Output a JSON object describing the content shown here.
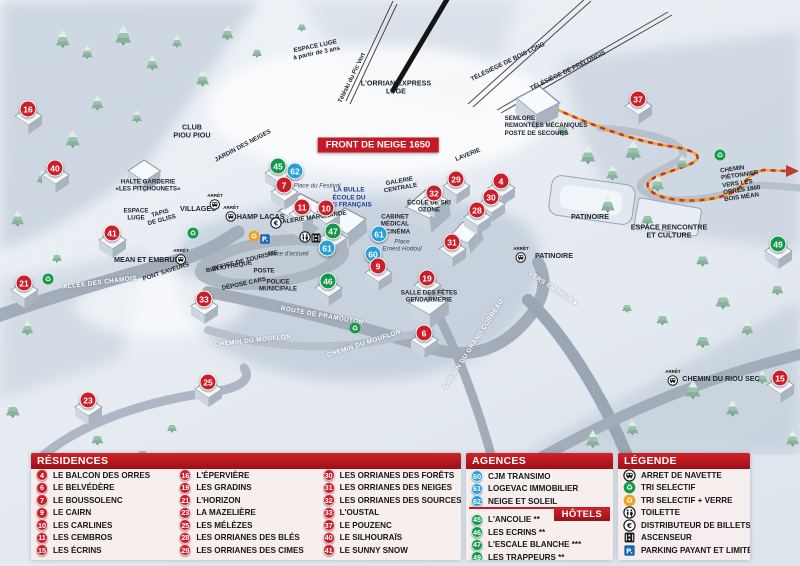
{
  "map": {
    "banner": "FRONT DE NEIGE 1650",
    "markers": [
      {
        "n": "16",
        "t": "r",
        "x": 28,
        "y": 109
      },
      {
        "n": "40",
        "t": "r",
        "x": 55,
        "y": 168
      },
      {
        "n": "21",
        "t": "r",
        "x": 24,
        "y": 283
      },
      {
        "n": "41",
        "t": "r",
        "x": 112,
        "y": 233
      },
      {
        "n": "33",
        "t": "r",
        "x": 204,
        "y": 299
      },
      {
        "n": "23",
        "t": "r",
        "x": 88,
        "y": 400
      },
      {
        "n": "25",
        "t": "r",
        "x": 208,
        "y": 382
      },
      {
        "n": "45",
        "t": "g",
        "x": 278,
        "y": 166
      },
      {
        "n": "62",
        "t": "b",
        "x": 295,
        "y": 171
      },
      {
        "n": "7",
        "t": "r",
        "x": 284,
        "y": 185
      },
      {
        "n": "11",
        "t": "r",
        "x": 302,
        "y": 207
      },
      {
        "n": "10",
        "t": "r",
        "x": 326,
        "y": 208
      },
      {
        "n": "47",
        "t": "g",
        "x": 333,
        "y": 231
      },
      {
        "n": "61",
        "t": "b",
        "x": 327,
        "y": 248
      },
      {
        "n": "61",
        "t": "b",
        "x": 379,
        "y": 234
      },
      {
        "n": "60",
        "t": "b",
        "x": 373,
        "y": 254
      },
      {
        "n": "9",
        "t": "r",
        "x": 378,
        "y": 266
      },
      {
        "n": "46",
        "t": "g",
        "x": 328,
        "y": 281
      },
      {
        "n": "19",
        "t": "r",
        "x": 427,
        "y": 278
      },
      {
        "n": "31",
        "t": "r",
        "x": 452,
        "y": 242
      },
      {
        "n": "6",
        "t": "r",
        "x": 424,
        "y": 333
      },
      {
        "n": "29",
        "t": "r",
        "x": 456,
        "y": 179
      },
      {
        "n": "32",
        "t": "r",
        "x": 434,
        "y": 193
      },
      {
        "n": "4",
        "t": "r",
        "x": 501,
        "y": 181
      },
      {
        "n": "30",
        "t": "r",
        "x": 491,
        "y": 197
      },
      {
        "n": "28",
        "t": "r",
        "x": 477,
        "y": 210
      },
      {
        "n": "37",
        "t": "r",
        "x": 638,
        "y": 99
      },
      {
        "n": "49",
        "t": "g",
        "x": 778,
        "y": 244
      },
      {
        "n": "15",
        "t": "r",
        "x": 780,
        "y": 378
      }
    ],
    "labels": [
      {
        "t": "ESPACE LUGE\nà partir de 3 ans",
        "x": 316,
        "y": 50,
        "r": -12,
        "c": "tiny"
      },
      {
        "t": "Téléski du Pic Vert",
        "x": 352,
        "y": 78,
        "r": -64,
        "c": "tiny"
      },
      {
        "t": "L'ORRIAN EXPRESS\nLUGE",
        "x": 396,
        "y": 88,
        "r": 0,
        "c": "dark"
      },
      {
        "t": "TÉLÉSIÈGE DE BOIS LONG",
        "x": 508,
        "y": 62,
        "r": -26,
        "c": "tiny"
      },
      {
        "t": "TÉLÉSIÈGE DE PRÉLONGIS",
        "x": 568,
        "y": 71,
        "r": -26,
        "c": "tiny"
      },
      {
        "t": "CLUB\nPIOU PIOU",
        "x": 192,
        "y": 132,
        "r": 0,
        "c": "dark"
      },
      {
        "t": "JARDIN DES NEIGES",
        "x": 243,
        "y": 146,
        "r": -28,
        "c": "tiny"
      },
      {
        "t": "HALTE GARDERIE\n«LES PITCHOUNETS»",
        "x": 148,
        "y": 186,
        "r": 0,
        "c": "tiny"
      },
      {
        "t": "ESPACE\nLUGE",
        "x": 136,
        "y": 215,
        "r": 0,
        "c": "tiny"
      },
      {
        "t": "TAPIS\nDE GLISS",
        "x": 161,
        "y": 217,
        "r": -15,
        "c": "tiny"
      },
      {
        "t": "VILLAGES",
        "x": 198,
        "y": 209,
        "r": 0,
        "c": "dark"
      },
      {
        "t": "CHAMP LACAS",
        "x": 258,
        "y": 217,
        "r": 0,
        "c": "dark"
      },
      {
        "t": "SEMLORE\nREMONTÉES MÉCANIQUES\nPOSTE DE SECOURS",
        "x": 546,
        "y": 126,
        "r": 0,
        "c": "tiny left"
      },
      {
        "t": "LAVERIE",
        "x": 468,
        "y": 155,
        "r": -22,
        "c": "tiny"
      },
      {
        "t": "GALERIE\nCENTRALE",
        "x": 400,
        "y": 185,
        "r": -10,
        "c": "tiny"
      },
      {
        "t": "Place du Festival",
        "x": 317,
        "y": 186,
        "r": 0,
        "c": "ital"
      },
      {
        "t": "LA BULLE\nÉCOLE DU\nSKI FRANÇAIS",
        "x": 349,
        "y": 198,
        "r": 0,
        "c": "blue"
      },
      {
        "t": "GALERIE MARCHANDE",
        "x": 312,
        "y": 218,
        "r": -8,
        "c": "tiny"
      },
      {
        "t": "ÉCOLE DE SKI\nOZONE",
        "x": 429,
        "y": 207,
        "r": 0,
        "c": "tiny"
      },
      {
        "t": "CABINET\nMÉDICAL",
        "x": 395,
        "y": 221,
        "r": 0,
        "c": "tiny"
      },
      {
        "t": "CINÉMA",
        "x": 398,
        "y": 232,
        "r": 0,
        "c": "tiny"
      },
      {
        "t": "Place\nErnest Hodoul",
        "x": 402,
        "y": 246,
        "r": 0,
        "c": "ital"
      },
      {
        "t": "Place d'accueil",
        "x": 288,
        "y": 254,
        "r": 0,
        "c": "ital"
      },
      {
        "t": "OFFICE DE TOURISME",
        "x": 245,
        "y": 261,
        "r": -14,
        "c": "tiny"
      },
      {
        "t": "BIBLIOTHÈQUE",
        "x": 229,
        "y": 267,
        "r": -10,
        "c": "tiny"
      },
      {
        "t": "POSTE",
        "x": 264,
        "y": 271,
        "r": 0,
        "c": "tiny"
      },
      {
        "t": "DÉPOSE CARS",
        "x": 244,
        "y": 284,
        "r": -12,
        "c": "tiny"
      },
      {
        "t": "POLICE\nMUNICIPALE",
        "x": 278,
        "y": 286,
        "r": 0,
        "c": "tiny"
      },
      {
        "t": "PONT SAVEURS",
        "x": 166,
        "y": 272,
        "r": -18,
        "c": "tiny"
      },
      {
        "t": "MEAN ET EMBRUN",
        "x": 147,
        "y": 260,
        "r": 0,
        "c": "dark"
      },
      {
        "t": "ALLÉE DES CHAMOIS",
        "x": 100,
        "y": 283,
        "r": -7,
        "c": "road"
      },
      {
        "t": "ROUTE DE PRAMOUTON",
        "x": 322,
        "y": 316,
        "r": 10,
        "c": "road"
      },
      {
        "t": "CHEMIN DU MOUFLON",
        "x": 253,
        "y": 341,
        "r": -6,
        "c": "road"
      },
      {
        "t": "CHEMIN DU MOUFLON",
        "x": 364,
        "y": 344,
        "r": -18,
        "c": "road"
      },
      {
        "t": "CHEMIN DU GRAND CORBEAU",
        "x": 474,
        "y": 344,
        "r": -57,
        "c": "road"
      },
      {
        "t": "VERS EMBRUN ▸",
        "x": 553,
        "y": 289,
        "r": 33,
        "c": "road"
      },
      {
        "t": "SALLE DES FÊTES\nGENDARMERIE",
        "x": 429,
        "y": 297,
        "r": 0,
        "c": "tiny"
      },
      {
        "t": "PATINOIRE",
        "x": 590,
        "y": 217,
        "r": 0,
        "c": "dark"
      },
      {
        "t": "PATINOIRE",
        "x": 554,
        "y": 256,
        "r": 0,
        "c": "dark"
      },
      {
        "t": "ESPACE RENCONTRE\nET CULTURE",
        "x": 669,
        "y": 232,
        "r": 0,
        "c": "dark"
      },
      {
        "t": "CHEMIN PIÉTONNIER\nVERS LES ORRES 1800\nBOIS MÉAN",
        "x": 748,
        "y": 182,
        "r": -8,
        "c": "tiny left"
      },
      {
        "t": "CHEMIN DU RIOU SEC",
        "x": 721,
        "y": 379,
        "r": 0,
        "c": "dark"
      }
    ],
    "icons": [
      {
        "t": "bus",
        "x": 215,
        "y": 202
      },
      {
        "t": "bus",
        "x": 231,
        "y": 214
      },
      {
        "t": "bus",
        "x": 181,
        "y": 257
      },
      {
        "t": "bus",
        "x": 521,
        "y": 255
      },
      {
        "t": "bus",
        "x": 673,
        "y": 378
      },
      {
        "t": "recycle-green",
        "x": 193,
        "y": 233
      },
      {
        "t": "recycle-green",
        "x": 48,
        "y": 279
      },
      {
        "t": "recycle-green",
        "x": 355,
        "y": 328
      },
      {
        "t": "recycle-green",
        "x": 720,
        "y": 155
      },
      {
        "t": "recycle-yellow",
        "x": 254,
        "y": 236
      },
      {
        "t": "parking",
        "x": 265,
        "y": 239
      },
      {
        "t": "euro",
        "x": 276,
        "y": 223
      },
      {
        "t": "wc",
        "x": 305,
        "y": 237
      },
      {
        "t": "elevator",
        "x": 316,
        "y": 238
      }
    ]
  },
  "legend": {
    "residences": {
      "title": "RÉSIDENCES",
      "items": [
        {
          "n": "4",
          "label": "LE BALCON DES ORRES"
        },
        {
          "n": "6",
          "label": "LE BELVÉDÈRE"
        },
        {
          "n": "7",
          "label": "LE BOUSSOLENC"
        },
        {
          "n": "9",
          "label": "LE CAIRN"
        },
        {
          "n": "10",
          "label": "LES CARLINES"
        },
        {
          "n": "11",
          "label": "LES CEMBROS"
        },
        {
          "n": "15",
          "label": "LES ÉCRINS"
        },
        {
          "n": "16",
          "label": "L'ÉPERVIÈRE"
        },
        {
          "n": "19",
          "label": "LES GRADINS"
        },
        {
          "n": "21",
          "label": "L'HORIZON"
        },
        {
          "n": "23",
          "label": "LA MAZELIÈRE"
        },
        {
          "n": "25",
          "label": "LES MÉLÈZES"
        },
        {
          "n": "28",
          "label": "LES ORRIANES DES BLÉS"
        },
        {
          "n": "29",
          "label": "LES ORRIANES DES CIMES"
        },
        {
          "n": "30",
          "label": "LES ORRIANES DES FORÊTS"
        },
        {
          "n": "31",
          "label": "LES ORRIANES DES NEIGES"
        },
        {
          "n": "32",
          "label": "LES ORRIANES DES SOURCES"
        },
        {
          "n": "33",
          "label": "L'OUSTAL"
        },
        {
          "n": "37",
          "label": "LE POUZENC"
        },
        {
          "n": "40",
          "label": "LE SILHOURAÏS"
        },
        {
          "n": "41",
          "label": "LE SUNNY SNOW"
        }
      ]
    },
    "agencies": {
      "title": "AGENCES IMMOBILIÈRES",
      "items": [
        {
          "n": "60",
          "label": "CJM TRANSIMO"
        },
        {
          "n": "61",
          "label": "LOGEVAC IMMOBILIER"
        },
        {
          "n": "62",
          "label": "NEIGE ET SOLEIL"
        }
      ]
    },
    "hotels": {
      "title": "HÔTELS",
      "items": [
        {
          "n": "45",
          "label": "L'ANCOLIE **"
        },
        {
          "n": "46",
          "label": "LES ECRINS **"
        },
        {
          "n": "47",
          "label": "L'ESCALE BLANCHE ***"
        },
        {
          "n": "49",
          "label": "LES TRAPPEURS **"
        }
      ]
    },
    "key": {
      "title": "LÉGENDE",
      "items": [
        {
          "icon": "bus",
          "label": "ARRET DE NAVETTE"
        },
        {
          "icon": "recycle-green",
          "label": "TRI SELECTIF"
        },
        {
          "icon": "recycle-yellow",
          "label": "TRI SELECTIF + VERRE"
        },
        {
          "icon": "wc",
          "label": "TOILETTE"
        },
        {
          "icon": "euro",
          "label": "DISTRIBUTEUR DE BILLETS"
        },
        {
          "icon": "elevator",
          "label": "ASCENSEUR"
        },
        {
          "icon": "parking",
          "label": "PARKING PAYANT ET LIMITÉ"
        }
      ]
    }
  },
  "colors": {
    "residence_red": "#cb1e2b",
    "hotel_green": "#12984b",
    "agency_blue": "#27a0d7",
    "header_red": "#c01c24",
    "recycle_green": "#159a48",
    "recycle_yellow": "#f0a21d",
    "parking_blue": "#1668b2",
    "path_orange": "#f5a623"
  }
}
